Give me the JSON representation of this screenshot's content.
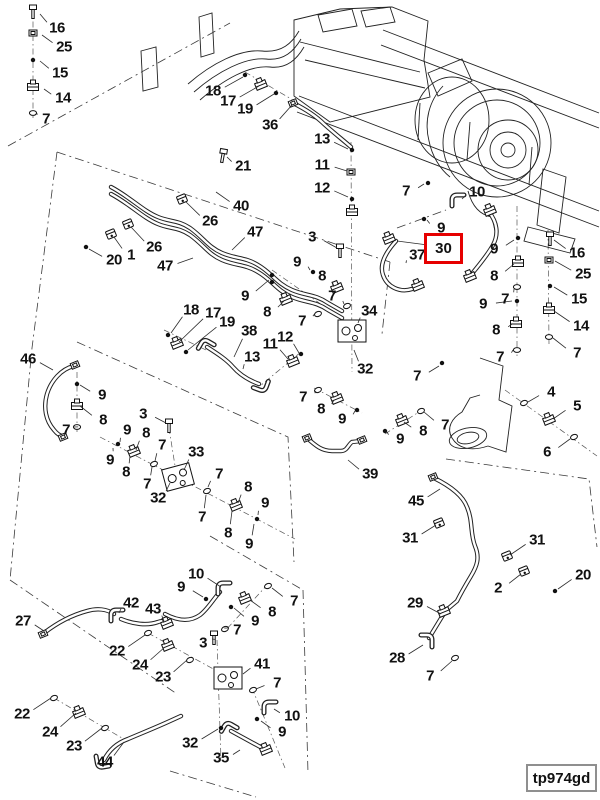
{
  "figure": {
    "code": "tp974gd"
  },
  "highlight": {
    "label": "30",
    "color": "#e60000",
    "box": {
      "x": 424,
      "y": 233,
      "w": 39,
      "h": 31
    },
    "leader": {
      "tx": 397,
      "ty": 241
    }
  },
  "callouts": [
    {
      "n": "16",
      "x": 57,
      "y": 28,
      "tx": 40,
      "ty": 14
    },
    {
      "n": "25",
      "x": 64,
      "y": 47,
      "tx": 42,
      "ty": 35
    },
    {
      "n": "15",
      "x": 60,
      "y": 73,
      "tx": 40,
      "ty": 61
    },
    {
      "n": "14",
      "x": 63,
      "y": 98,
      "tx": 44,
      "ty": 89
    },
    {
      "n": "7",
      "x": 46,
      "y": 119,
      "tx": 38,
      "ty": 114
    },
    {
      "n": "18",
      "x": 213,
      "y": 91,
      "tx": 243,
      "ty": 77
    },
    {
      "n": "17",
      "x": 228,
      "y": 101,
      "tx": 259,
      "ty": 86
    },
    {
      "n": "19",
      "x": 245,
      "y": 109,
      "tx": 274,
      "ty": 94
    },
    {
      "n": "36",
      "x": 270,
      "y": 125,
      "tx": 292,
      "ty": 105
    },
    {
      "n": "13",
      "x": 322,
      "y": 139,
      "tx": 348,
      "ty": 149
    },
    {
      "n": "11",
      "x": 322,
      "y": 165,
      "tx": 347,
      "ty": 171
    },
    {
      "n": "12",
      "x": 322,
      "y": 188,
      "tx": 348,
      "ty": 197
    },
    {
      "n": "7",
      "x": 406,
      "y": 191,
      "tx": 424,
      "ty": 184
    },
    {
      "n": "10",
      "x": 477,
      "y": 192,
      "tx": 462,
      "ty": 199
    },
    {
      "n": "9",
      "x": 441,
      "y": 228,
      "tx": 427,
      "ty": 220
    },
    {
      "n": "37",
      "x": 417,
      "y": 255,
      "tx": 406,
      "ty": 263
    },
    {
      "n": "9",
      "x": 494,
      "y": 249,
      "tx": 514,
      "ty": 240
    },
    {
      "n": "8",
      "x": 494,
      "y": 276,
      "tx": 514,
      "ty": 264
    },
    {
      "n": "7",
      "x": 505,
      "y": 299,
      "tx": 514,
      "ty": 289
    },
    {
      "n": "9",
      "x": 483,
      "y": 304,
      "tx": 512,
      "ty": 301
    },
    {
      "n": "8",
      "x": 496,
      "y": 330,
      "tx": 512,
      "ty": 324
    },
    {
      "n": "7",
      "x": 500,
      "y": 357,
      "tx": 513,
      "ty": 350
    },
    {
      "n": "16",
      "x": 577,
      "y": 253,
      "tx": 554,
      "ty": 240
    },
    {
      "n": "25",
      "x": 583,
      "y": 274,
      "tx": 555,
      "ty": 261
    },
    {
      "n": "15",
      "x": 579,
      "y": 299,
      "tx": 554,
      "ty": 287
    },
    {
      "n": "14",
      "x": 581,
      "y": 326,
      "tx": 554,
      "ty": 311
    },
    {
      "n": "7",
      "x": 577,
      "y": 353,
      "tx": 553,
      "ty": 338
    },
    {
      "n": "4",
      "x": 551,
      "y": 392,
      "tx": 528,
      "ty": 402
    },
    {
      "n": "5",
      "x": 577,
      "y": 406,
      "tx": 553,
      "ty": 419
    },
    {
      "n": "6",
      "x": 547,
      "y": 452,
      "tx": 570,
      "ty": 439
    },
    {
      "n": "7",
      "x": 445,
      "y": 425,
      "tx": 424,
      "ty": 412
    },
    {
      "n": "21",
      "x": 243,
      "y": 166,
      "tx": 227,
      "ty": 157
    },
    {
      "n": "40",
      "x": 241,
      "y": 206,
      "tx": 216,
      "ty": 192
    },
    {
      "n": "26",
      "x": 210,
      "y": 221,
      "tx": 186,
      "ty": 202
    },
    {
      "n": "47",
      "x": 255,
      "y": 232,
      "tx": 232,
      "ty": 250
    },
    {
      "n": "26",
      "x": 154,
      "y": 247,
      "tx": 131,
      "ty": 227
    },
    {
      "n": "1",
      "x": 131,
      "y": 255,
      "tx": 114,
      "ty": 237
    },
    {
      "n": "20",
      "x": 114,
      "y": 260,
      "tx": 89,
      "ty": 249
    },
    {
      "n": "47",
      "x": 165,
      "y": 266,
      "tx": 193,
      "ty": 258
    },
    {
      "n": "9",
      "x": 245,
      "y": 296,
      "tx": 269,
      "ty": 280
    },
    {
      "n": "3",
      "x": 312,
      "y": 237,
      "tx": 337,
      "ty": 248
    },
    {
      "n": "9",
      "x": 297,
      "y": 262,
      "tx": 310,
      "ty": 270
    },
    {
      "n": "8",
      "x": 322,
      "y": 276,
      "tx": 334,
      "ty": 286
    },
    {
      "n": "7",
      "x": 332,
      "y": 296,
      "tx": 344,
      "ty": 304
    },
    {
      "n": "34",
      "x": 369,
      "y": 311,
      "tx": 358,
      "ty": 323
    },
    {
      "n": "18",
      "x": 191,
      "y": 310,
      "tx": 171,
      "ty": 333
    },
    {
      "n": "17",
      "x": 213,
      "y": 313,
      "tx": 179,
      "ty": 342
    },
    {
      "n": "19",
      "x": 227,
      "y": 322,
      "tx": 188,
      "ty": 350
    },
    {
      "n": "38",
      "x": 249,
      "y": 331,
      "tx": 234,
      "ty": 357
    },
    {
      "n": "13",
      "x": 252,
      "y": 357,
      "tx": 243,
      "ty": 369
    },
    {
      "n": "11",
      "x": 270,
      "y": 344,
      "tx": 288,
      "ty": 359
    },
    {
      "n": "12",
      "x": 285,
      "y": 337,
      "tx": 299,
      "ty": 353
    },
    {
      "n": "8",
      "x": 267,
      "y": 312,
      "tx": 284,
      "ty": 301
    },
    {
      "n": "7",
      "x": 302,
      "y": 321,
      "tx": 316,
      "ty": 312
    },
    {
      "n": "32",
      "x": 365,
      "y": 369,
      "tx": 354,
      "ty": 350
    },
    {
      "n": "7",
      "x": 303,
      "y": 397,
      "tx": 316,
      "ty": 391
    },
    {
      "n": "8",
      "x": 321,
      "y": 409,
      "tx": 334,
      "ty": 400
    },
    {
      "n": "9",
      "x": 342,
      "y": 419,
      "tx": 355,
      "ty": 411
    },
    {
      "n": "39",
      "x": 370,
      "y": 474,
      "tx": 348,
      "ty": 460
    },
    {
      "n": "7",
      "x": 417,
      "y": 376,
      "tx": 439,
      "ty": 366
    },
    {
      "n": "9",
      "x": 400,
      "y": 439,
      "tx": 387,
      "ty": 432
    },
    {
      "n": "8",
      "x": 423,
      "y": 431,
      "tx": 404,
      "ty": 422
    },
    {
      "n": "46",
      "x": 28,
      "y": 359,
      "tx": 53,
      "ty": 370
    },
    {
      "n": "9",
      "x": 102,
      "y": 395,
      "tx": 80,
      "ty": 385
    },
    {
      "n": "8",
      "x": 103,
      "y": 420,
      "tx": 80,
      "ty": 406
    },
    {
      "n": "7",
      "x": 66,
      "y": 430,
      "tx": 74,
      "ty": 427
    },
    {
      "n": "3",
      "x": 143,
      "y": 414,
      "tx": 166,
      "ty": 423
    },
    {
      "n": "9",
      "x": 127,
      "y": 430,
      "tx": 120,
      "ty": 442
    },
    {
      "n": "8",
      "x": 146,
      "y": 433,
      "tx": 136,
      "ty": 450
    },
    {
      "n": "7",
      "x": 162,
      "y": 445,
      "tx": 155,
      "ty": 461
    },
    {
      "n": "9",
      "x": 110,
      "y": 460,
      "tx": 113,
      "ty": 448
    },
    {
      "n": "8",
      "x": 126,
      "y": 472,
      "tx": 130,
      "ty": 456
    },
    {
      "n": "7",
      "x": 147,
      "y": 484,
      "tx": 152,
      "ty": 467
    },
    {
      "n": "32",
      "x": 158,
      "y": 498,
      "tx": 170,
      "ty": 483
    },
    {
      "n": "33",
      "x": 196,
      "y": 452,
      "tx": 184,
      "ty": 470
    },
    {
      "n": "7",
      "x": 219,
      "y": 474,
      "tx": 208,
      "ty": 487
    },
    {
      "n": "7",
      "x": 202,
      "y": 517,
      "tx": 206,
      "ty": 495
    },
    {
      "n": "8",
      "x": 248,
      "y": 487,
      "tx": 238,
      "ty": 503
    },
    {
      "n": "9",
      "x": 265,
      "y": 503,
      "tx": 258,
      "ty": 515
    },
    {
      "n": "8",
      "x": 228,
      "y": 533,
      "tx": 232,
      "ty": 511
    },
    {
      "n": "9",
      "x": 249,
      "y": 544,
      "tx": 254,
      "ty": 524
    },
    {
      "n": "45",
      "x": 416,
      "y": 501,
      "tx": 440,
      "ty": 489
    },
    {
      "n": "31",
      "x": 410,
      "y": 538,
      "tx": 436,
      "ty": 525
    },
    {
      "n": "31",
      "x": 537,
      "y": 540,
      "tx": 510,
      "ty": 555
    },
    {
      "n": "2",
      "x": 498,
      "y": 588,
      "tx": 521,
      "ty": 574
    },
    {
      "n": "20",
      "x": 583,
      "y": 575,
      "tx": 558,
      "ty": 589
    },
    {
      "n": "29",
      "x": 415,
      "y": 603,
      "tx": 441,
      "ty": 614
    },
    {
      "n": "28",
      "x": 397,
      "y": 658,
      "tx": 423,
      "ty": 645
    },
    {
      "n": "7",
      "x": 430,
      "y": 676,
      "tx": 452,
      "ty": 661
    },
    {
      "n": "27",
      "x": 23,
      "y": 621,
      "tx": 44,
      "ty": 631
    },
    {
      "n": "42",
      "x": 131,
      "y": 603,
      "tx": 119,
      "ty": 613
    },
    {
      "n": "43",
      "x": 153,
      "y": 609,
      "tx": 164,
      "ty": 621
    },
    {
      "n": "22",
      "x": 117,
      "y": 651,
      "tx": 145,
      "ty": 635
    },
    {
      "n": "24",
      "x": 140,
      "y": 665,
      "tx": 165,
      "ty": 647
    },
    {
      "n": "23",
      "x": 163,
      "y": 677,
      "tx": 187,
      "ty": 660
    },
    {
      "n": "22",
      "x": 22,
      "y": 714,
      "tx": 51,
      "ty": 698
    },
    {
      "n": "24",
      "x": 50,
      "y": 732,
      "tx": 76,
      "ty": 713
    },
    {
      "n": "23",
      "x": 74,
      "y": 746,
      "tx": 102,
      "ty": 728
    },
    {
      "n": "44",
      "x": 105,
      "y": 762,
      "tx": 124,
      "ty": 742
    },
    {
      "n": "10",
      "x": 196,
      "y": 574,
      "tx": 221,
      "ty": 587
    },
    {
      "n": "9",
      "x": 181,
      "y": 587,
      "tx": 203,
      "ty": 597
    },
    {
      "n": "7",
      "x": 294,
      "y": 601,
      "tx": 272,
      "ty": 588
    },
    {
      "n": "8",
      "x": 272,
      "y": 612,
      "tx": 250,
      "ty": 600
    },
    {
      "n": "9",
      "x": 255,
      "y": 621,
      "tx": 234,
      "ty": 608
    },
    {
      "n": "7",
      "x": 237,
      "y": 630,
      "tx": 228,
      "ty": 628
    },
    {
      "n": "3",
      "x": 203,
      "y": 643,
      "tx": 212,
      "ty": 639
    },
    {
      "n": "41",
      "x": 262,
      "y": 664,
      "tx": 243,
      "ty": 674
    },
    {
      "n": "7",
      "x": 277,
      "y": 683,
      "tx": 256,
      "ty": 689
    },
    {
      "n": "10",
      "x": 292,
      "y": 716,
      "tx": 274,
      "ty": 709
    },
    {
      "n": "9",
      "x": 282,
      "y": 732,
      "tx": 261,
      "ty": 721
    },
    {
      "n": "32",
      "x": 190,
      "y": 743,
      "tx": 218,
      "ty": 729
    },
    {
      "n": "35",
      "x": 221,
      "y": 758,
      "tx": 240,
      "ty": 750
    }
  ],
  "parts": [
    [
      "bolt",
      33,
      11,
      0
    ],
    [
      "nut",
      33,
      33,
      0
    ],
    [
      "dot",
      33,
      60
    ],
    [
      "fit",
      33,
      87,
      0
    ],
    [
      "ring",
      33,
      113,
      0
    ],
    [
      "dot",
      245,
      75
    ],
    [
      "fit",
      261,
      85
    ],
    [
      "dot",
      276,
      93
    ],
    [
      "nut",
      293,
      103
    ],
    [
      "dot",
      352,
      150
    ],
    [
      "nut",
      351,
      172,
      0
    ],
    [
      "dot",
      352,
      199
    ],
    [
      "fit",
      352,
      212,
      0
    ],
    [
      "dot",
      428,
      183
    ],
    [
      "dot",
      424,
      219
    ],
    [
      "elbow",
      458,
      201,
      0
    ],
    [
      "fit",
      490,
      211
    ],
    [
      "dot",
      518,
      238
    ],
    [
      "fit",
      518,
      263,
      0
    ],
    [
      "ring",
      517,
      287,
      0
    ],
    [
      "dot",
      517,
      301
    ],
    [
      "fit",
      516,
      324,
      0
    ],
    [
      "ring",
      517,
      350,
      0
    ],
    [
      "fit",
      470,
      277
    ],
    [
      "bolt",
      550,
      238,
      0
    ],
    [
      "nut",
      549,
      260,
      0
    ],
    [
      "dot",
      550,
      286
    ],
    [
      "fit",
      549,
      310,
      0
    ],
    [
      "ring",
      549,
      337,
      0
    ],
    [
      "ring",
      524,
      403
    ],
    [
      "fit",
      549,
      420
    ],
    [
      "ring",
      574,
      437
    ],
    [
      "bolt",
      223,
      155,
      10
    ],
    [
      "clamp",
      182,
      199
    ],
    [
      "clamp",
      128,
      224
    ],
    [
      "clamp",
      111,
      234
    ],
    [
      "dot",
      86,
      247
    ],
    [
      "dot",
      272,
      275
    ],
    [
      "dot",
      272,
      282
    ],
    [
      "bolt",
      340,
      250,
      0
    ],
    [
      "dot",
      313,
      272
    ],
    [
      "fit",
      337,
      288
    ],
    [
      "ring",
      347,
      306
    ],
    [
      "fit",
      286,
      300
    ],
    [
      "ring",
      318,
      314
    ],
    [
      "valve",
      352,
      331,
      0
    ],
    [
      "dot",
      168,
      335
    ],
    [
      "fit",
      177,
      344
    ],
    [
      "dot",
      186,
      352
    ],
    [
      "elbow",
      206,
      347,
      30
    ],
    [
      "elbow",
      261,
      384,
      200
    ],
    [
      "dot",
      301,
      354
    ],
    [
      "fit",
      293,
      362
    ],
    [
      "nut",
      75,
      365
    ],
    [
      "dot",
      77,
      384
    ],
    [
      "fit",
      77,
      406,
      0
    ],
    [
      "ring",
      77,
      427,
      0
    ],
    [
      "nut",
      63,
      437
    ],
    [
      "bolt",
      169,
      425,
      0
    ],
    [
      "dot",
      118,
      444
    ],
    [
      "fit",
      134,
      452
    ],
    [
      "ring",
      154,
      464
    ],
    [
      "valve",
      178,
      477,
      -15
    ],
    [
      "ring",
      207,
      491
    ],
    [
      "fit",
      236,
      506
    ],
    [
      "dot",
      257,
      519
    ],
    [
      "ring",
      318,
      390
    ],
    [
      "fit",
      337,
      399
    ],
    [
      "dot",
      357,
      410
    ],
    [
      "nut",
      307,
      438
    ],
    [
      "nut",
      362,
      440
    ],
    [
      "dot",
      442,
      363
    ],
    [
      "dot",
      385,
      431
    ],
    [
      "fit",
      402,
      421
    ],
    [
      "ring",
      421,
      411
    ],
    [
      "nut",
      433,
      477
    ],
    [
      "clamp",
      439,
      523
    ],
    [
      "clamp",
      507,
      556
    ],
    [
      "clamp",
      524,
      571
    ],
    [
      "dot",
      555,
      591
    ],
    [
      "fit",
      444,
      612
    ],
    [
      "elbow",
      426,
      641,
      90
    ],
    [
      "ring",
      455,
      658
    ],
    [
      "nut",
      43,
      634
    ],
    [
      "elbow",
      117,
      616,
      0
    ],
    [
      "fit",
      167,
      624
    ],
    [
      "ring",
      148,
      633
    ],
    [
      "fit",
      168,
      646
    ],
    [
      "ring",
      190,
      660
    ],
    [
      "ring",
      54,
      698
    ],
    [
      "fit",
      79,
      713
    ],
    [
      "ring",
      105,
      728
    ],
    [
      "elbow",
      103,
      761,
      260
    ],
    [
      "elbow",
      224,
      589,
      0
    ],
    [
      "dot",
      206,
      599
    ],
    [
      "ring",
      268,
      586
    ],
    [
      "fit",
      245,
      599
    ],
    [
      "dot",
      231,
      607
    ],
    [
      "ring",
      225,
      629
    ],
    [
      "bolt",
      214,
      637,
      0
    ],
    [
      "valve",
      228,
      678,
      0
    ],
    [
      "ring",
      253,
      690
    ],
    [
      "elbow",
      270,
      708,
      0
    ],
    [
      "dot",
      257,
      719
    ],
    [
      "elbow",
      229,
      730,
      30
    ],
    [
      "fit",
      266,
      750
    ],
    [
      "dot",
      221,
      728
    ],
    [
      "fit",
      389,
      239
    ],
    [
      "fit",
      418,
      286
    ]
  ],
  "centerlines": [
    "M33,8 L33,118",
    "M351,142 L352,372",
    "M548,230 L549,344",
    "M517,206 L517,356",
    "M505,390 L597,456",
    "M77,372 L77,433",
    "M100,437 L295,539",
    "M217,640 L221,760",
    "M148,633 L226,676",
    "M54,698 L127,741",
    "M268,584 L224,632",
    "M252,688 L285,768",
    "M169,428 L176,472",
    "M272,270 L352,326",
    "M245,72 L293,100",
    "M164,330 L206,350",
    "M301,352 L260,386",
    "M385,434 L425,408",
    "M314,388 L362,413"
  ],
  "phantom": [
    "M8,146 L230,23",
    "M57,152 L32,348 L10,580",
    "M57,152 L390,262",
    "M390,262 L382,334",
    "M77,342 L288,437 L294,562",
    "M10,580 L177,694",
    "M303,590 L308,773",
    "M210,536 L303,590",
    "M446,459 L589,479 L597,547",
    "M170,771 L256,797",
    "M397,228 L446,210"
  ]
}
